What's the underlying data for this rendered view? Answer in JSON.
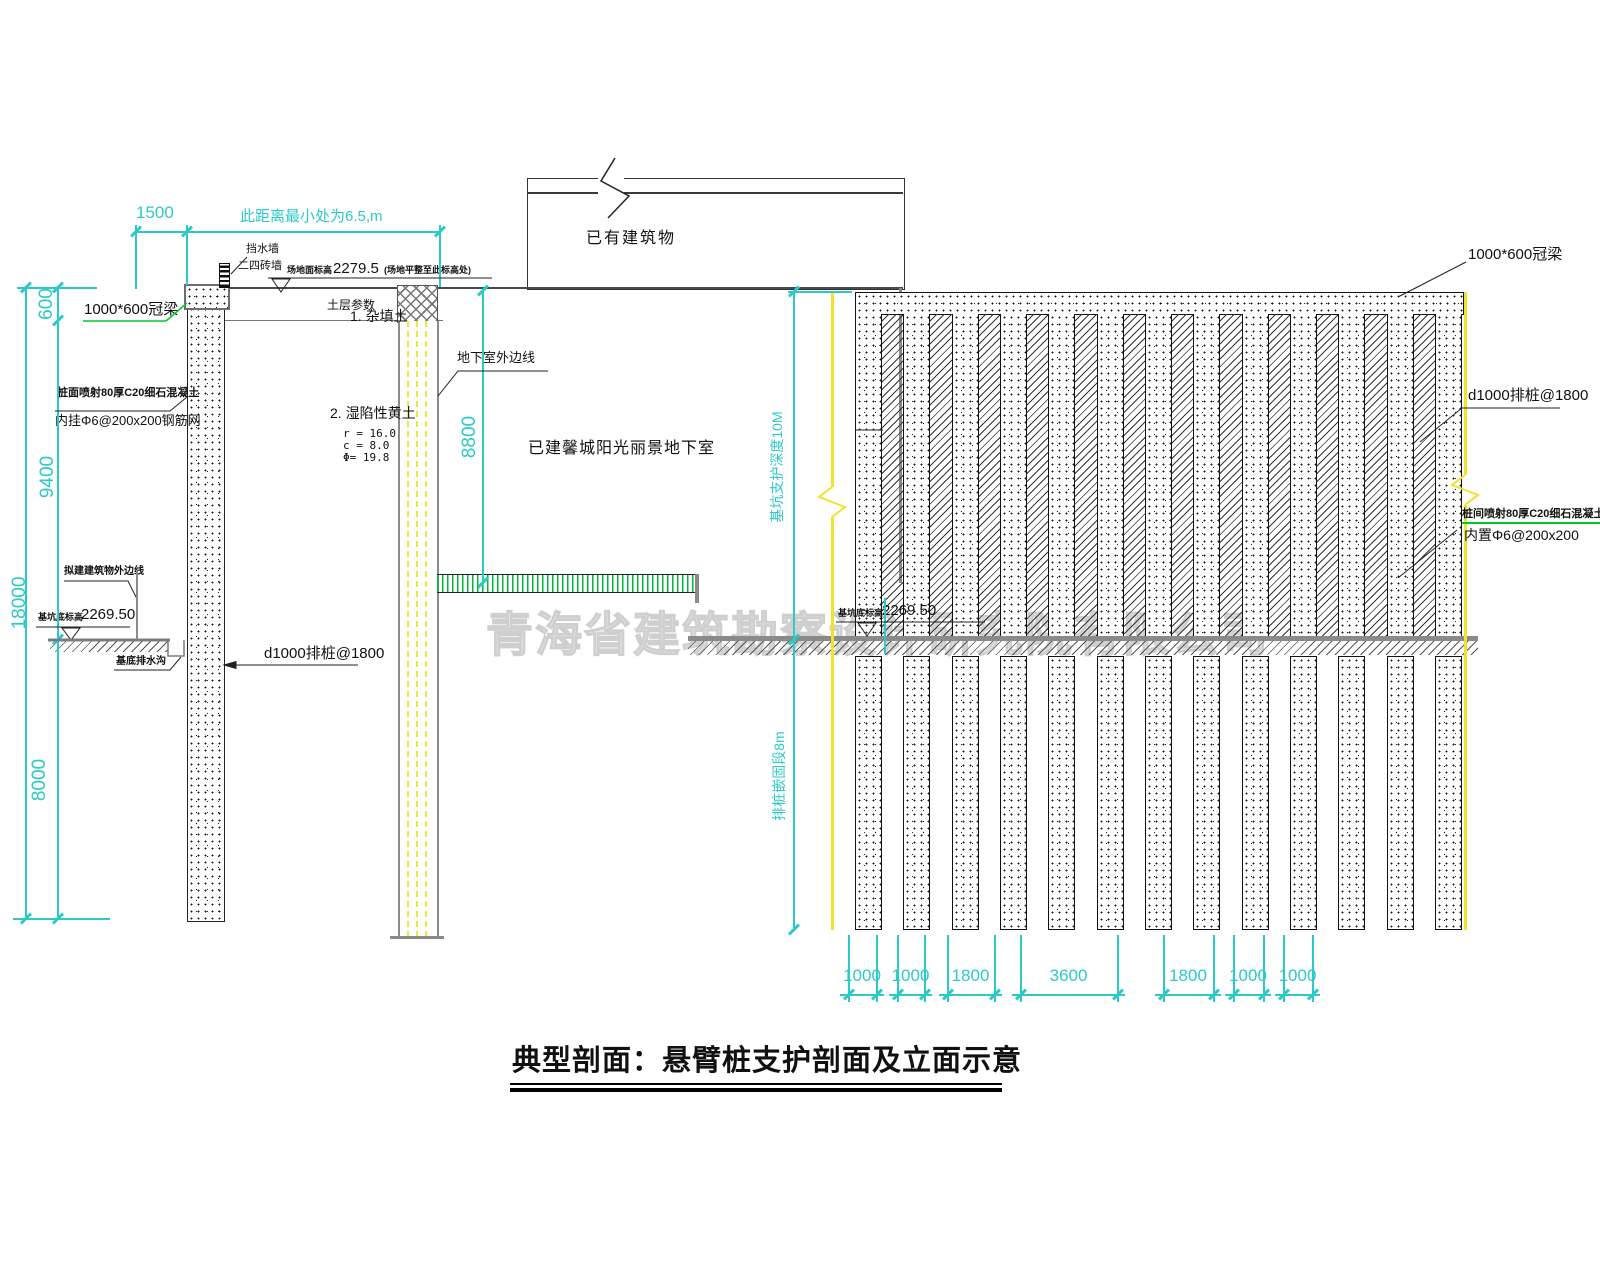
{
  "title": "典型剖面：悬臂桩支护剖面及立面示意",
  "watermark": "青海省建筑勘察设计研究院有限公司",
  "section": {
    "dims": {
      "d1500": "1500",
      "top_note": "此距离最小处为6.5,m",
      "d600": "600",
      "d9400": "9400",
      "d18000": "18000",
      "d8000": "8000",
      "d8800": "8800"
    },
    "labels": {
      "crown_beam": "1000*600冠梁",
      "water_wall": "挡水墙",
      "brick_wall": "二四砖墙",
      "site_elev_prefix": "场地面标高",
      "site_elev_value": "2279.5",
      "site_elev_suffix": "(场地平整至此标高处)",
      "soil_title": "土层参数",
      "soil1": "1. 杂填土",
      "soil2": "2. 湿陷性黄土",
      "soil2_r": "r =  16.0",
      "soil2_c": "c =  8.0",
      "soil2_phi": "Φ=  19.8",
      "shotcrete_1": "桩面喷射80厚C20细石混凝土",
      "shotcrete_2": "内挂Φ6@200x200钢筋网",
      "building_outline": "拟建建筑物外边线",
      "pit_elev_prefix": "基坑底标高",
      "pit_elev_value": "2269.50",
      "drain": "基底排水沟",
      "pile": "d1000排桩@1800",
      "basement_edge": "地下室外边线",
      "existing_building": "已有建筑物",
      "existing_basement": "已建馨城阳光丽景地下室"
    }
  },
  "elevation": {
    "labels": {
      "crown_beam": "1000*600冠梁",
      "pile": "d1000排桩@1800",
      "shotcrete_1": "桩间喷射80厚C20细石混凝土",
      "shotcrete_2": "内置Φ6@200x200",
      "depth": "基坑支护深度10M",
      "embed": "排桩嵌固段8m",
      "pit_elev_prefix": "基坑底标高",
      "pit_elev_value": "2269.50"
    },
    "pile_count": 13,
    "bottom_dims": [
      "1000",
      "1000",
      "1800",
      "3600",
      "1800",
      "1000",
      "1000"
    ]
  }
}
